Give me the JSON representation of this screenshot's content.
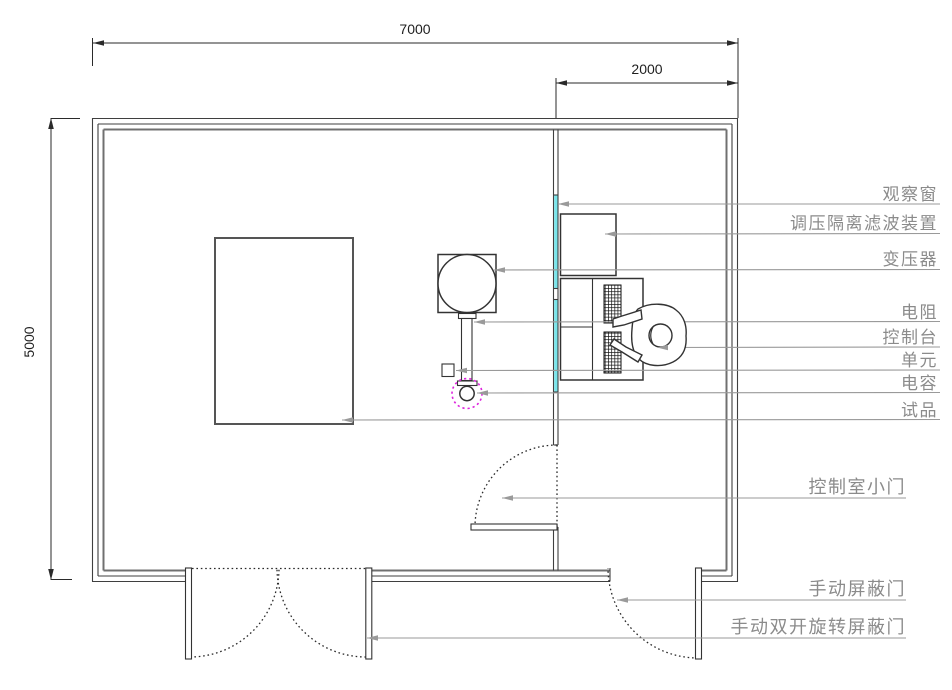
{
  "dimensions": {
    "overall_width": "7000",
    "control_room_width": "2000",
    "overall_depth": "5000"
  },
  "labels": {
    "observation_window": "观察窗",
    "filter_device": "调压隔离滤波装置",
    "transformer": "变压器",
    "resistor": "电阻",
    "console": "控制台",
    "unit": "单元",
    "capacitor": "电容",
    "test_specimen": "试品",
    "control_room_door": "控制室小门",
    "manual_shield_door": "手动屏蔽门",
    "manual_double_rotating_shield_door": "手动双开旋转屏蔽门"
  },
  "colors": {
    "window": "#79e6ec",
    "capacitor_marker": "#dd22dd",
    "leader": "#9a9a9a",
    "label": "#8b8b8b",
    "wall": "#3f3f3f"
  }
}
